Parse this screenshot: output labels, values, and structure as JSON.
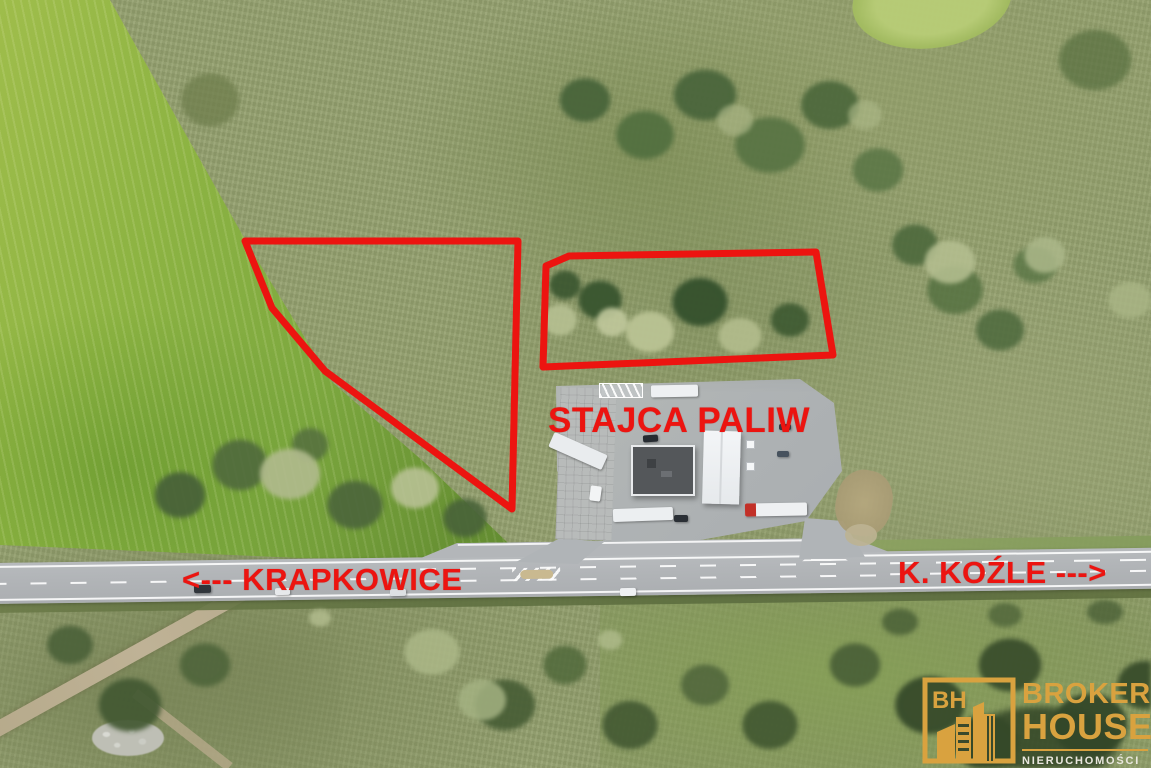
{
  "scene": {
    "station_sign": "STAJCA PALIW",
    "direction_left": "<--- KRAPKOWICE",
    "direction_right": "K. KOŹLE --->",
    "annotation_color": "#ec1410"
  },
  "logo": {
    "monogram": "BH",
    "brand_line1": "BROKER",
    "brand_line2": "HOUSE",
    "tagline": "NIERUCHOMOŚCI",
    "gold": "#d9a23f",
    "tagline_color": "#eae7de"
  }
}
